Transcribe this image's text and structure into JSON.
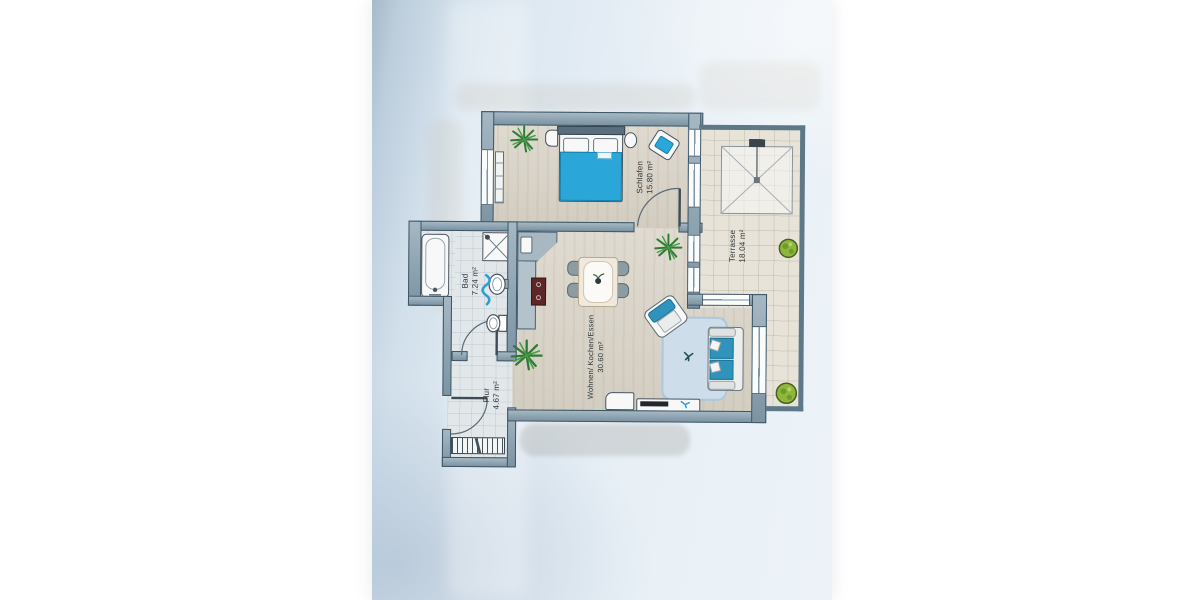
{
  "photo": {
    "description": "Photographed architectural floor plan of an apartment on light blue paper"
  },
  "rooms": [
    {
      "id": "schlafen",
      "name": "Schlafen",
      "area": "15.80 m²"
    },
    {
      "id": "terrasse",
      "name": "Terrasse",
      "area": "18.04 m²"
    },
    {
      "id": "bad",
      "name": "Bad",
      "area": "7.24 m²"
    },
    {
      "id": "wohnen",
      "name": "Wohnen/ Kochen/Essen",
      "area": "30.60 m²"
    },
    {
      "id": "flur",
      "name": "Flur",
      "area": "4.67 m²"
    }
  ],
  "colors": {
    "paper": "#dde8f1",
    "wall": "#87a0b0",
    "wall_outline": "#3d5666",
    "accent_teal": "#2aa7d8",
    "sofa_teal": "#2f93bb",
    "stove_red": "#5e2726",
    "plant_green": "#2e7d32",
    "bush_green": "#8eb83d",
    "wood_floor": "#d9d3c7",
    "tile_floor": "#e2e7ea",
    "rug_blue": "#cdddea"
  },
  "icons": [
    "bed-icon",
    "pillow-icon",
    "nightstand-icon",
    "radiator-icon",
    "chair-icon",
    "plant-icon",
    "bush-icon",
    "bathtub-icon",
    "shower-icon",
    "washbasin-icon",
    "toilet-icon",
    "towel-icon",
    "door-swing-icon",
    "kitchen-counter-icon",
    "stove-icon",
    "sink-icon",
    "dining-table-icon",
    "sofa-icon",
    "armchair-icon",
    "rug-icon",
    "tv-icon",
    "tv-lowboard-icon",
    "cabinet-icon",
    "awning-icon",
    "stairs-hatch-icon",
    "window-icon"
  ]
}
